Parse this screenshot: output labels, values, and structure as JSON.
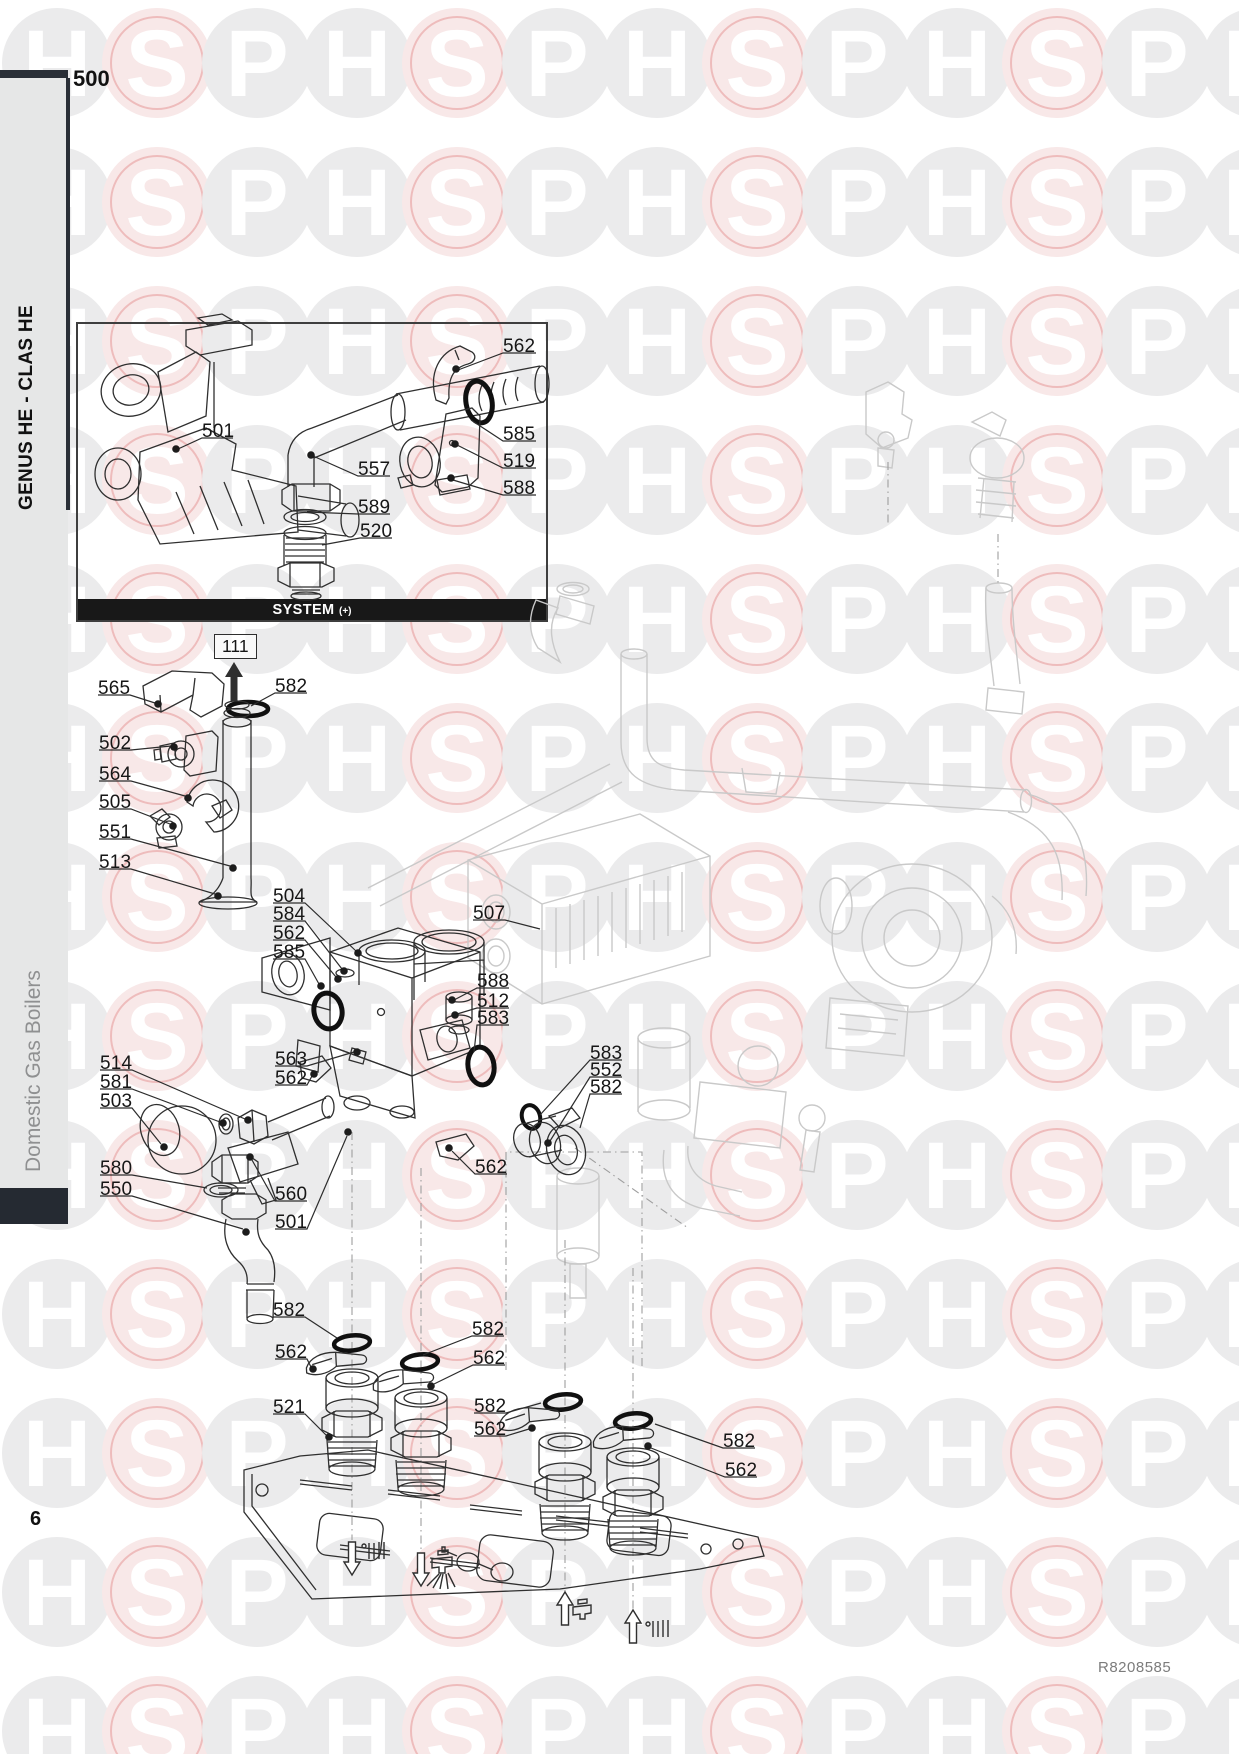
{
  "header": {
    "section_number": "500"
  },
  "sidebar": {
    "model_title": "GENUS HE - CLAS HE",
    "category": "Domestic Gas Boilers"
  },
  "footer": {
    "page_number": "6",
    "reference": "R8208585"
  },
  "inset": {
    "caption": "SYSTEM",
    "caption_suffix": "(+)"
  },
  "watermark": {
    "letters": [
      "H",
      "S",
      "P"
    ],
    "gray_circle": "#ebebec",
    "pink_circle": "#f8e8e8",
    "pink_ring": "#eebcbc",
    "letter_color": "#ffffff"
  },
  "colors": {
    "accent_dark": "#2a2f37",
    "caption_bar": "#181818",
    "sidebar_gray": "#e6e7e7",
    "line_dark": "#2f2f2f",
    "line_ghost": "#c9c9c9"
  },
  "diagram": {
    "boxed_callout": "111",
    "callouts": [
      {
        "t": "562",
        "x": 503,
        "y": 336,
        "line": [
          536,
          353,
          503,
          353,
          458,
          370
        ],
        "dot": [
          456,
          369
        ]
      },
      {
        "t": "585",
        "x": 503,
        "y": 424,
        "line": [
          536,
          441,
          503,
          441,
          471,
          420
        ],
        "dot": null
      },
      {
        "t": "519",
        "x": 503,
        "y": 451,
        "line": [
          536,
          468,
          503,
          468,
          457,
          445
        ],
        "dot": [
          455,
          444
        ]
      },
      {
        "t": "588",
        "x": 503,
        "y": 478,
        "line": [
          536,
          495,
          503,
          495,
          453,
          480
        ],
        "dot": [
          451,
          478
        ]
      },
      {
        "t": "501",
        "x": 202,
        "y": 421,
        "line": [
          233,
          438,
          202,
          438,
          178,
          449
        ],
        "dot": [
          176,
          449
        ]
      },
      {
        "t": "557",
        "x": 358,
        "y": 459,
        "line": [
          390,
          476,
          358,
          476,
          313,
          456
        ],
        "dot": [
          311,
          455
        ]
      },
      {
        "t": "589",
        "x": 358,
        "y": 497,
        "line": [
          390,
          514,
          358,
          514,
          307,
          512
        ],
        "dot": null
      },
      {
        "t": "520",
        "x": 360,
        "y": 521,
        "line": [
          392,
          538,
          360,
          538,
          322,
          545
        ],
        "dot": null
      },
      {
        "t": "565",
        "x": 98,
        "y": 678,
        "line": [
          98,
          695,
          130,
          695,
          155,
          703
        ],
        "dot": [
          158,
          704
        ]
      },
      {
        "t": "582",
        "x": 275,
        "y": 676,
        "line": [
          307,
          693,
          275,
          693,
          251,
          706
        ],
        "dot": null
      },
      {
        "t": "502",
        "x": 99,
        "y": 733,
        "line": [
          99,
          750,
          131,
          750,
          171,
          746
        ],
        "dot": [
          174,
          747
        ]
      },
      {
        "t": "564",
        "x": 99,
        "y": 764,
        "line": [
          99,
          781,
          131,
          781,
          185,
          796
        ],
        "dot": [
          188,
          798
        ]
      },
      {
        "t": "505",
        "x": 99,
        "y": 792,
        "line": [
          99,
          809,
          131,
          809,
          170,
          824
        ],
        "dot": [
          173,
          826
        ]
      },
      {
        "t": "551",
        "x": 99,
        "y": 822,
        "line": [
          99,
          839,
          131,
          839,
          230,
          866
        ],
        "dot": [
          233,
          868
        ]
      },
      {
        "t": "513",
        "x": 99,
        "y": 852,
        "line": [
          99,
          869,
          131,
          869,
          215,
          894
        ],
        "dot": [
          218,
          896
        ]
      },
      {
        "t": "504",
        "x": 273,
        "y": 886,
        "line": [
          273,
          903,
          305,
          903,
          356,
          951
        ],
        "dot": [
          358,
          953
        ]
      },
      {
        "t": "584",
        "x": 273,
        "y": 904,
        "line": [
          273,
          921,
          305,
          921,
          342,
          969
        ],
        "dot": [
          344,
          971
        ]
      },
      {
        "t": "562",
        "x": 273,
        "y": 923,
        "line": [
          273,
          940,
          305,
          940,
          336,
          977
        ],
        "dot": [
          338,
          979
        ]
      },
      {
        "t": "585",
        "x": 273,
        "y": 942,
        "line": [
          273,
          959,
          305,
          959,
          319,
          984
        ],
        "dot": [
          321,
          986
        ]
      },
      {
        "t": "507",
        "x": 473,
        "y": 903,
        "line": [
          473,
          920,
          505,
          920,
          540,
          929
        ],
        "dot": null
      },
      {
        "t": "588",
        "x": 477,
        "y": 971,
        "line": [
          509,
          988,
          477,
          988,
          454,
          1000
        ],
        "dot": [
          452,
          1000
        ]
      },
      {
        "t": "512",
        "x": 477,
        "y": 991,
        "line": [
          509,
          1008,
          477,
          1008,
          457,
          1014
        ],
        "dot": [
          455,
          1015
        ]
      },
      {
        "t": "583",
        "x": 477,
        "y": 1008,
        "line": [
          509,
          1025,
          477,
          1025,
          474,
          1052
        ],
        "dot": null
      },
      {
        "t": "563",
        "x": 275,
        "y": 1049,
        "line": [
          275,
          1066,
          307,
          1066,
          354,
          1052
        ],
        "dot": [
          357,
          1052
        ]
      },
      {
        "t": "562",
        "x": 275,
        "y": 1068,
        "line": [
          275,
          1085,
          307,
          1085,
          312,
          1076
        ],
        "dot": [
          314,
          1074
        ]
      },
      {
        "t": "514",
        "x": 100,
        "y": 1053,
        "line": [
          100,
          1070,
          132,
          1070,
          245,
          1119
        ],
        "dot": [
          248,
          1120
        ]
      },
      {
        "t": "581",
        "x": 100,
        "y": 1072,
        "line": [
          100,
          1089,
          132,
          1089,
          220,
          1122
        ],
        "dot": [
          223,
          1123
        ]
      },
      {
        "t": "503",
        "x": 100,
        "y": 1091,
        "line": [
          100,
          1108,
          132,
          1108,
          161,
          1144
        ],
        "dot": [
          164,
          1147
        ]
      },
      {
        "t": "580",
        "x": 100,
        "y": 1158,
        "line": [
          100,
          1175,
          132,
          1175,
          207,
          1188
        ],
        "dot": null
      },
      {
        "t": "550",
        "x": 100,
        "y": 1179,
        "line": [
          100,
          1196,
          132,
          1196,
          243,
          1229
        ],
        "dot": [
          246,
          1232
        ]
      },
      {
        "t": "560",
        "x": 275,
        "y": 1184,
        "line": [
          307,
          1201,
          275,
          1201,
          252,
          1160
        ],
        "dot": [
          250,
          1157
        ]
      },
      {
        "t": "501",
        "x": 275,
        "y": 1212,
        "line": [
          275,
          1229,
          307,
          1229,
          347,
          1136
        ],
        "dot": [
          348,
          1132
        ]
      },
      {
        "t": "583",
        "x": 590,
        "y": 1043,
        "line": [
          622,
          1060,
          590,
          1060,
          540,
          1115
        ],
        "dot": null
      },
      {
        "t": "552",
        "x": 590,
        "y": 1060,
        "line": [
          622,
          1077,
          590,
          1077,
          550,
          1141
        ],
        "dot": [
          548,
          1143
        ]
      },
      {
        "t": "582",
        "x": 590,
        "y": 1077,
        "line": [
          622,
          1094,
          590,
          1094,
          580,
          1128
        ],
        "dot": null
      },
      {
        "t": "562",
        "x": 475,
        "y": 1157,
        "line": [
          507,
          1174,
          475,
          1174,
          452,
          1151
        ],
        "dot": [
          449,
          1148
        ]
      },
      {
        "t": "582",
        "x": 273,
        "y": 1300,
        "line": [
          273,
          1317,
          305,
          1317,
          337,
          1338
        ],
        "dot": null
      },
      {
        "t": "562",
        "x": 275,
        "y": 1342,
        "line": [
          275,
          1359,
          307,
          1359,
          311,
          1367
        ],
        "dot": [
          313,
          1369
        ]
      },
      {
        "t": "521",
        "x": 273,
        "y": 1397,
        "line": [
          273,
          1414,
          305,
          1414,
          326,
          1435
        ],
        "dot": [
          329,
          1437
        ]
      },
      {
        "t": "582",
        "x": 472,
        "y": 1319,
        "line": [
          504,
          1336,
          472,
          1336,
          423,
          1355
        ],
        "dot": null
      },
      {
        "t": "562",
        "x": 473,
        "y": 1348,
        "line": [
          505,
          1365,
          473,
          1365,
          434,
          1384
        ],
        "dot": [
          431,
          1386
        ]
      },
      {
        "t": "582",
        "x": 474,
        "y": 1396,
        "line": [
          474,
          1413,
          506,
          1413,
          541,
          1403
        ],
        "dot": null
      },
      {
        "t": "562",
        "x": 474,
        "y": 1419,
        "line": [
          474,
          1436,
          506,
          1436,
          529,
          1429
        ],
        "dot": [
          532,
          1428
        ]
      },
      {
        "t": "582",
        "x": 723,
        "y": 1431,
        "line": [
          755,
          1448,
          723,
          1448,
          655,
          1424
        ],
        "dot": null
      },
      {
        "t": "562",
        "x": 725,
        "y": 1460,
        "line": [
          757,
          1477,
          725,
          1477,
          651,
          1448
        ],
        "dot": [
          648,
          1446
        ]
      }
    ]
  }
}
